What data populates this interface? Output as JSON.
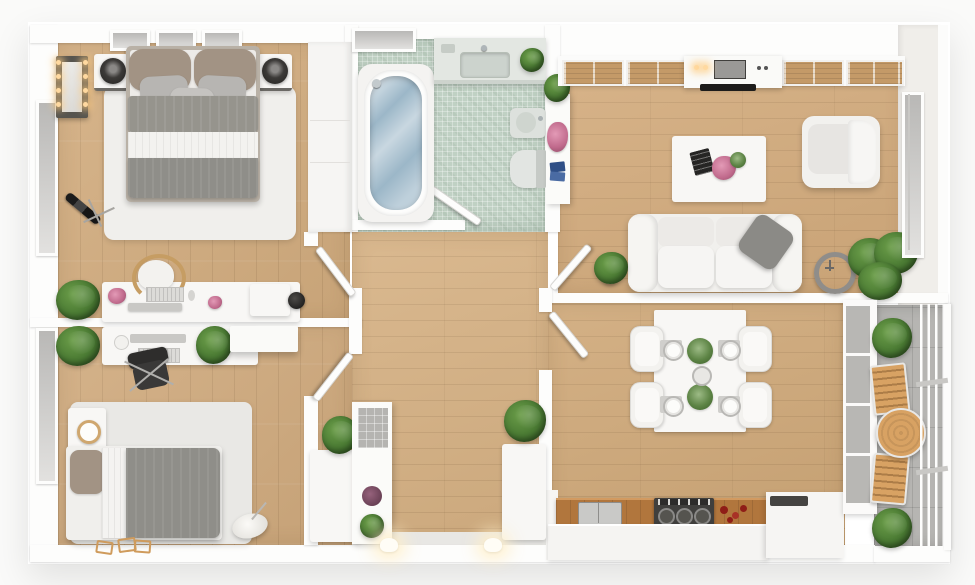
{
  "scene": {
    "type": "3d-floor-plan-render",
    "view": "top-down",
    "rooms": [
      {
        "id": "bedroom-1",
        "area": "top-left",
        "furniture": [
          "double-bed",
          "nightstand-left",
          "nightstand-right",
          "table-lamps",
          "lighted-vanity-mirror",
          "telescope",
          "rug",
          "desk-with-chair",
          "wardrobe",
          "windows"
        ]
      },
      {
        "id": "bathroom",
        "area": "top-center",
        "furniture": [
          "bathtub",
          "vanity-sink",
          "toilet",
          "bidet",
          "open-door",
          "window",
          "plant"
        ]
      },
      {
        "id": "living-room",
        "area": "top-right",
        "furniture": [
          "sofa",
          "gray-cushion",
          "armchair",
          "coffee-table",
          "wall-clock",
          "potted-plants",
          "flower-shelf",
          "kitchenette-counter",
          "slatted-windows",
          "curtained-window"
        ]
      },
      {
        "id": "bedroom-2",
        "area": "bottom-left",
        "furniture": [
          "single-bed",
          "desk-with-monitor",
          "office-chair",
          "wall-cabinet-clock",
          "rug",
          "slippers",
          "plants",
          "window"
        ]
      },
      {
        "id": "hallway",
        "area": "center",
        "furniture": [
          "four-open-doors",
          "shoe-cabinets",
          "display-shelf",
          "wall-sconces",
          "plants"
        ]
      },
      {
        "id": "dining-room",
        "area": "bottom-right",
        "furniture": [
          "dining-table",
          "four-chairs",
          "place-settings",
          "kitchen-counter",
          "sink",
          "gas-stove",
          "storage-unit"
        ]
      },
      {
        "id": "balcony",
        "area": "right",
        "furniture": [
          "round-wood-table",
          "two-deck-chairs",
          "shrubs",
          "railing"
        ]
      }
    ]
  },
  "palette": {
    "background": "#fafaf9",
    "wall": "#fdfdfc",
    "wood_bedroom1": "#d2ac7e",
    "wood_bedroom2": "#d0aa7d",
    "wood_hall": "#d6b183",
    "wood_living": "#d3ab7c",
    "wood_dining": "#cfa878",
    "bath_tile": "#c0d1c4",
    "balcony_tile": "#b6b5b2",
    "rug_bedroom1": "#f0efec",
    "rug_bedroom2": "#e9e8e5",
    "duvet_bed1": "#96948d",
    "duvet_bed2": "#8f8e89",
    "pillow_taupe": "#a29384",
    "sofa": "#f1f0ed",
    "water": "#9cb7c8",
    "counter_wood": "#b1763d",
    "stove": "#403f3d",
    "fruit_red": "#8f1d17",
    "deck_wood": "#d8a263",
    "plant_green": "#4a7a33"
  }
}
